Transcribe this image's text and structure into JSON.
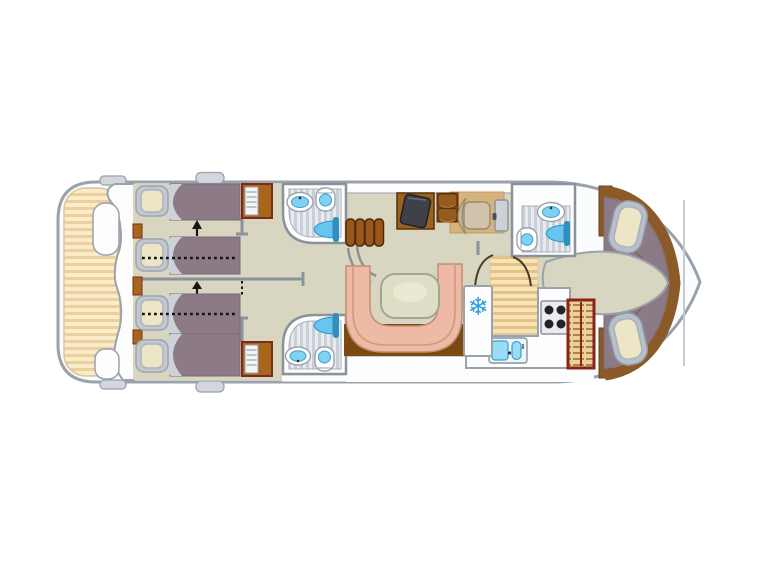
{
  "plan": {
    "kind": "boat-deck-floor-plan",
    "regions": [
      "aft-deck",
      "cabin-aft-port",
      "cabin-aft-starboard",
      "bathroom-aft-port",
      "bathroom-aft-starboard",
      "saloon",
      "helm-station",
      "galley",
      "bathroom-bow",
      "cabin-bow",
      "bow-deck"
    ]
  },
  "icons": {
    "snowflake": "❄"
  },
  "colors": {
    "page_bg": "#ffffff",
    "hull_fill": "#fbfcfd",
    "hull_stroke": "#9aa2ac",
    "cleat": "#d3d7dd",
    "deck_base": "#f8ecca",
    "deck_stripe": "#eccf9b",
    "deck_edge": "#dcc79c",
    "floor": "#d8d6c0",
    "wall": "#8a929c",
    "line_soft": "#aab0b8",
    "mattress": "#8d7a87",
    "mattress_edge": "#7a6a78",
    "duvet": "#ccd2d8",
    "headboard": "#c3c8d0",
    "pillow": "#ece5c6",
    "pillow_edge": "#a9b1bd",
    "wood": "#a8651c",
    "wood_dark": "#7b2a1c",
    "shelf": "#f3f4f5",
    "bath_bg": "#fdfdfe",
    "bath_floor": "#e7ebef",
    "bath_stripe": "#c9d0d9",
    "porcelain": "#ffffff",
    "water": "#7fd2f2",
    "water_edge": "#3f9fc9",
    "shower_fan": "#66c6ee",
    "shower_stem": "#2f8fc0",
    "step": "#9a571c",
    "step_edge": "#4f2708",
    "settee": "#eebaa6",
    "settee_edge": "#c08f74",
    "settee_line": "#cf9a80",
    "table": "#dedec4",
    "table_edge": "#a0a694",
    "table_hi": "#e9e9d4",
    "saloon_wood": "#7a4a10",
    "helm_mat": "#d6b27c",
    "helm_mat_edge": "#c09a60",
    "console": "#9a611f",
    "console_edge": "#5a3008",
    "panel": "#404148",
    "panel_edge": "#202127",
    "cabinet": "#7a4a16",
    "cabinet_door": "#945c1e",
    "cabinet_hi": "#b5803f",
    "seat": "#cfc3ab",
    "seat_back": "#c6b99e",
    "seat_edge": "#978a70",
    "side_door": "#ccd1d7",
    "handle": "#4a4f55",
    "snowflake": "#28a0e0",
    "galley_base": "#f6e3b8",
    "galley_stripe": "#e6c184",
    "counter": "#fdfdfe",
    "stove": "#e9ebee",
    "stove_edge": "#8a929c",
    "burner": "#232327",
    "sink_body": "#eef6fa",
    "basin": "#9adcf5",
    "basin_edge": "#3f9fc9",
    "faucet": "#223344",
    "larder_frame": "#8a2418",
    "larder_base": "#e9d09c",
    "larder_slat": "#b08440",
    "bow_trim": "#8a5a28",
    "bow_trim_dark": "#6b4017",
    "bow_headboard": "#b6bfca",
    "bow_headboard_edge": "#8d96a2",
    "seam": "#77616e",
    "ink": "#151515",
    "arc_dark": "#473a2c",
    "screen_line": "#c6cbd2"
  }
}
